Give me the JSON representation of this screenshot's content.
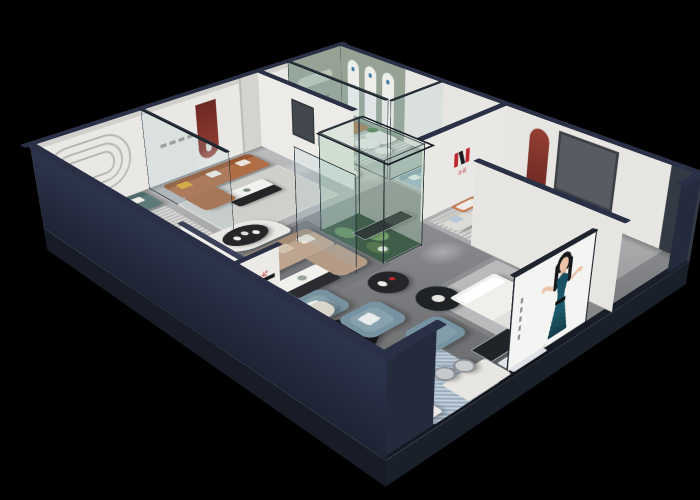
{
  "scene": {
    "title": "3D isometric cutaway render of a furniture showroom at night",
    "view": "dollhouse cutaway, black background",
    "background_color": "#000000",
    "brand": {
      "name": "华悦",
      "logo_letter": "H",
      "logo_red": "#c0272d",
      "logo_black": "#17181c"
    },
    "palette": {
      "exterior_wall": "#242b3d",
      "wall_top_trim": "#2a3147",
      "interior_wall": "#e9e8e4",
      "floor_light": "#b4b5b7",
      "floor_mid": "#97999c",
      "accent_green_wall": "#96a394",
      "accent_red_niche": "#7e302b",
      "sofa_cognac": "#b06e46",
      "sofa_teal": "#5e7a7a",
      "sofa_tan": "#bda58f",
      "sofa_light_blue": "#a2b8cc",
      "leather_blue_grey": "#7792a0",
      "accent_orange": "#e1862f",
      "terrarium_green": "#31493a",
      "poster_dress_teal": "#1d5a6b"
    },
    "rooms": [
      {
        "name": "teal-lounge",
        "wall_feature": "embossed oval line relief",
        "furniture": [
          "teal fabric sofa",
          "potted plant",
          "round white coffee table",
          "cognac armchair",
          "striped grey rug"
        ]
      },
      {
        "name": "cognac-lounge",
        "wall_feature": "dark red arched niche with spotlight",
        "furniture": [
          "cognac leather sofa with yellow pillow",
          "black and white coffee table",
          "glass partition",
          "grey rug"
        ]
      },
      {
        "name": "hallway-vignette",
        "furniture": [
          "white loveseat",
          "round side table",
          "dark framed artwork",
          "statuette"
        ]
      },
      {
        "name": "green-gallery-lounge",
        "wall_feature": "sage green accent wall with display niche",
        "furniture": [
          "brown leather sofa",
          "orange curved lounge chair",
          "white armchair",
          "round white coffee tables",
          "striped rug"
        ]
      },
      {
        "name": "blue-sofa-room",
        "wall_feature": "three white arched display panels on sage wall",
        "furniture": [
          "light blue fabric sofa",
          "sage loveseat",
          "white media cabinet",
          "round white table",
          "blue rug"
        ]
      },
      {
        "name": "white-sofa-room",
        "wall_feature": "red arched niche and dark window panel",
        "furniture": [
          "white fabric loveseat",
          "white chaise sofa",
          "black coffee table",
          "orange bench",
          "striped rug"
        ]
      },
      {
        "name": "bed-display-room",
        "furniture": [
          "white display bed",
          "black round display table"
        ]
      },
      {
        "name": "central-hall",
        "features": [
          "glass plant terrarium with cacti",
          "curved white display partition",
          "black pedestal display tables",
          "brand logo wall"
        ],
        "furniture": [
          "tan sectional sofa",
          "white coffee table",
          "blue-grey leather armchairs",
          "blue-grey ottoman",
          "long black media benches"
        ]
      },
      {
        "name": "dining-kitchen-corner",
        "furniture": [
          "black oval dining table",
          "cream dining chairs",
          "white kitchen islands",
          "bar stools",
          "blue mosaic rug"
        ]
      }
    ],
    "poster": {
      "subject": "fashion model in teal halter dress",
      "panel_color": "#f4f4f2",
      "details": [
        "black hair",
        "red lips",
        "vertical caption marks"
      ]
    }
  }
}
